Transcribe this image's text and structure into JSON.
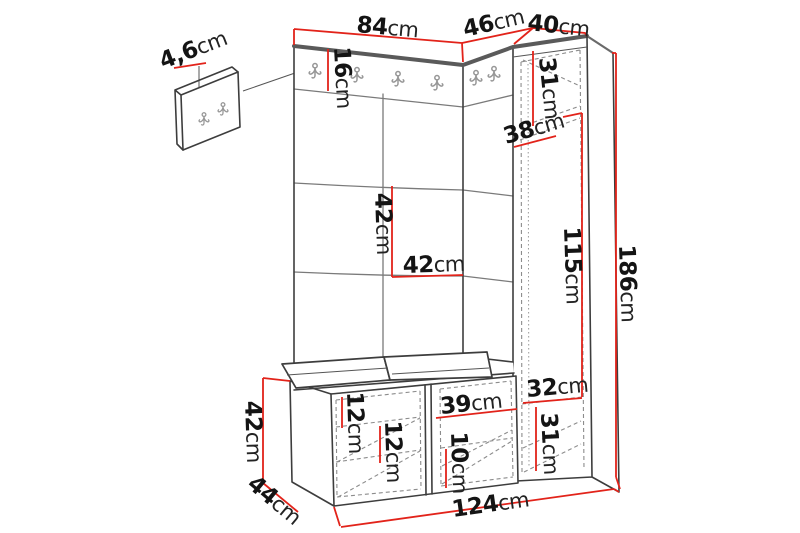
{
  "figure": {
    "kind": "furniture dimension diagram",
    "subject": "hallway set: wall hook panel, coat rack panel with cushions, tall corner cabinet and shoe bench",
    "measurement_unit": "cm",
    "icons": {
      "coat_hook": "double-prong coat hook"
    },
    "colors": {
      "background": "#ffffff",
      "dimension_line": "#e2231a",
      "outline": "#3d3d3d",
      "top_edge": "#5a5a5a",
      "label_text": "#141414"
    }
  },
  "dims": {
    "wall_panel_depth": {
      "value": "4,6",
      "unit": "cm"
    },
    "main_panel_width": {
      "value": "84",
      "unit": "cm"
    },
    "corner_section_width": {
      "value": "46",
      "unit": "cm"
    },
    "cabinet_width": {
      "value": "40",
      "unit": "cm"
    },
    "hook_rail_height": {
      "value": "16",
      "unit": "cm"
    },
    "cabinet_top_height": {
      "value": "31",
      "unit": "cm"
    },
    "cabinet_depth": {
      "value": "38",
      "unit": "cm"
    },
    "tile_height": {
      "value": "42",
      "unit": "cm"
    },
    "tile_width": {
      "value": "42",
      "unit": "cm"
    },
    "cabinet_middle_height": {
      "value": "115",
      "unit": "cm"
    },
    "total_height": {
      "value": "186",
      "unit": "cm"
    },
    "cabinet_inner_width": {
      "value": "32",
      "unit": "cm"
    },
    "shelf_gap_top": {
      "value": "12",
      "unit": "cm"
    },
    "shelf_gap_middle": {
      "value": "12",
      "unit": "cm"
    },
    "bench_inner_width": {
      "value": "39",
      "unit": "cm"
    },
    "shelf_gap_bottom": {
      "value": "10",
      "unit": "cm"
    },
    "cabinet_bottom_height": {
      "value": "31",
      "unit": "cm"
    },
    "bench_height": {
      "value": "42",
      "unit": "cm"
    },
    "bench_depth": {
      "value": "44",
      "unit": "cm"
    },
    "total_width": {
      "value": "124",
      "unit": "cm"
    }
  }
}
